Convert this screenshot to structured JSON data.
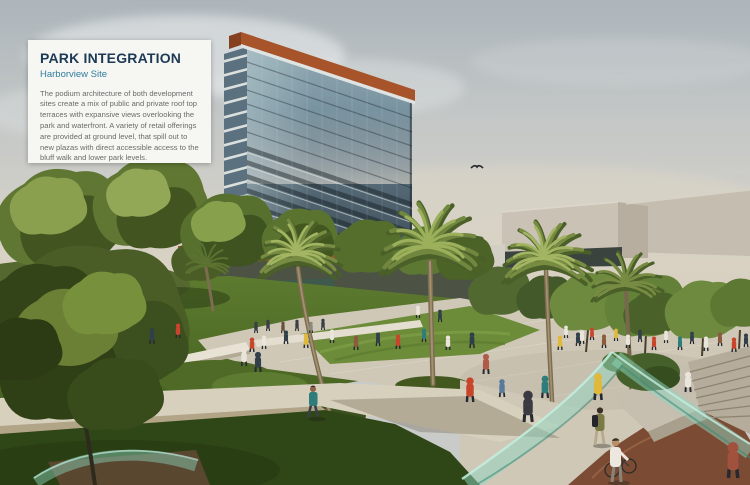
{
  "card": {
    "title": "PARK INTEGRATION",
    "subtitle": "Harborview Site",
    "body": "The podium architecture of both development sites create a mix of public and private roof top terraces with expansive views overlooking the park and waterfront. A variety of retail offerings are provided at ground level, that spill out to new plazas with direct accessible access to the bluff walk and lower park levels."
  },
  "scene": {
    "colors": {
      "card_bg": "#f6f6f3",
      "card_title": "#1d3a55",
      "card_subtitle": "#2f7e9e",
      "card_body": "#6b6b68",
      "sky_top": "#aeb6bb",
      "sky_horizon": "#d8d1c3",
      "tower_glass": "#5d7585",
      "tower_crown_orange": "#a8542b",
      "building_beige": "#cac3b5",
      "foliage_green": "#5f7733",
      "lawn_green": "#4e6b28",
      "paving": "#cfc8b7",
      "bike_path_brown": "#7c4b33",
      "railing_teal": "#8fd6c2"
    }
  }
}
